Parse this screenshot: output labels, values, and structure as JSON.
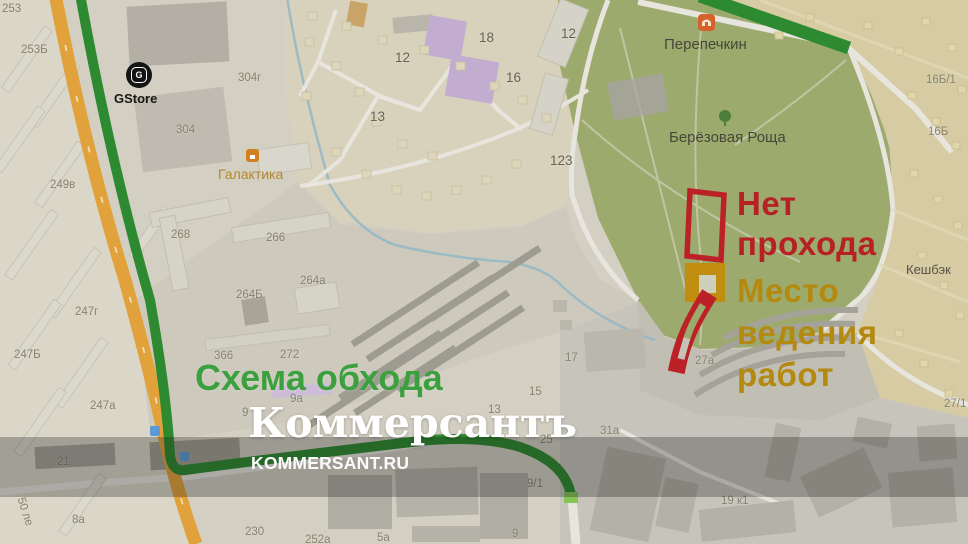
{
  "annotations": {
    "no_passage": {
      "label_lines": [
        "Нет",
        "прохода"
      ],
      "color": "#b72025"
    },
    "work_site": {
      "label_lines": [
        "Место",
        "ведения",
        "работ"
      ],
      "color": "#b3890f"
    },
    "bypass": {
      "label": "Схема обхода",
      "color": "#3da03f"
    }
  },
  "watermark": {
    "logo": "Коммерсантъ",
    "url_text": "KOMMERSANT.RU"
  },
  "places": {
    "gstore": "GStore",
    "galaktika": "Галактика",
    "perepechkin": "Перепечкин",
    "berezovaya_roscha": "Берёзовая Роща",
    "keshbek": "Кешбэк"
  },
  "building_numbers": [
    {
      "t": "253",
      "x": 2,
      "y": 3
    },
    {
      "t": "253Б",
      "x": 21,
      "y": 44
    },
    {
      "t": "304г",
      "x": 238,
      "y": 72
    },
    {
      "t": "304",
      "x": 176,
      "y": 124
    },
    {
      "t": "249в",
      "x": 50,
      "y": 179
    },
    {
      "t": "268",
      "x": 171,
      "y": 229
    },
    {
      "t": "266",
      "x": 266,
      "y": 232
    },
    {
      "t": "264а",
      "x": 300,
      "y": 275
    },
    {
      "t": "264Б",
      "x": 236,
      "y": 289
    },
    {
      "t": "247г",
      "x": 75,
      "y": 306
    },
    {
      "t": "247Б",
      "x": 14,
      "y": 349
    },
    {
      "t": "247а",
      "x": 90,
      "y": 400
    },
    {
      "t": "21",
      "x": 57,
      "y": 456
    },
    {
      "t": "8а",
      "x": 72,
      "y": 514
    },
    {
      "t": "230",
      "x": 245,
      "y": 526
    },
    {
      "t": "252а",
      "x": 305,
      "y": 534
    },
    {
      "t": "5а",
      "x": 377,
      "y": 532
    },
    {
      "t": "9",
      "x": 512,
      "y": 528
    },
    {
      "t": "9/1",
      "x": 527,
      "y": 478
    },
    {
      "t": "25",
      "x": 540,
      "y": 434
    },
    {
      "t": "13",
      "x": 488,
      "y": 404
    },
    {
      "t": "15",
      "x": 529,
      "y": 386
    },
    {
      "t": "31а",
      "x": 600,
      "y": 425
    },
    {
      "t": "9а",
      "x": 290,
      "y": 393
    },
    {
      "t": "9",
      "x": 242,
      "y": 407
    },
    {
      "t": "366",
      "x": 214,
      "y": 350
    },
    {
      "t": "272",
      "x": 280,
      "y": 349
    },
    {
      "t": "17",
      "x": 565,
      "y": 352
    },
    {
      "t": "27а",
      "x": 695,
      "y": 355
    },
    {
      "t": "123",
      "x": 550,
      "y": 153,
      "c": "m"
    },
    {
      "t": "12",
      "x": 395,
      "y": 50,
      "c": "m"
    },
    {
      "t": "12",
      "x": 561,
      "y": 26,
      "c": "m"
    },
    {
      "t": "18",
      "x": 479,
      "y": 30,
      "c": "m"
    },
    {
      "t": "16",
      "x": 506,
      "y": 70,
      "c": "m"
    },
    {
      "t": "13",
      "x": 370,
      "y": 109,
      "c": "m"
    },
    {
      "t": "16Б/1",
      "x": 926,
      "y": 74
    },
    {
      "t": "16Б",
      "x": 928,
      "y": 126
    },
    {
      "t": "27/1",
      "x": 944,
      "y": 398
    },
    {
      "t": "19 к1",
      "x": 721,
      "y": 495
    },
    {
      "t": "50 ле",
      "x": 26,
      "y": 496,
      "r": 72
    }
  ],
  "map_colors": {
    "park_green": "#9cab6d",
    "dacha_beige": "#d6cba2",
    "route_green": "#2e8a31",
    "route_tip_green": "#86c455",
    "road_orange": "#e2a23b",
    "annotation_red": "#bc2127",
    "annotation_gold": "#c08d10",
    "water_blue": "#93b7c4"
  }
}
